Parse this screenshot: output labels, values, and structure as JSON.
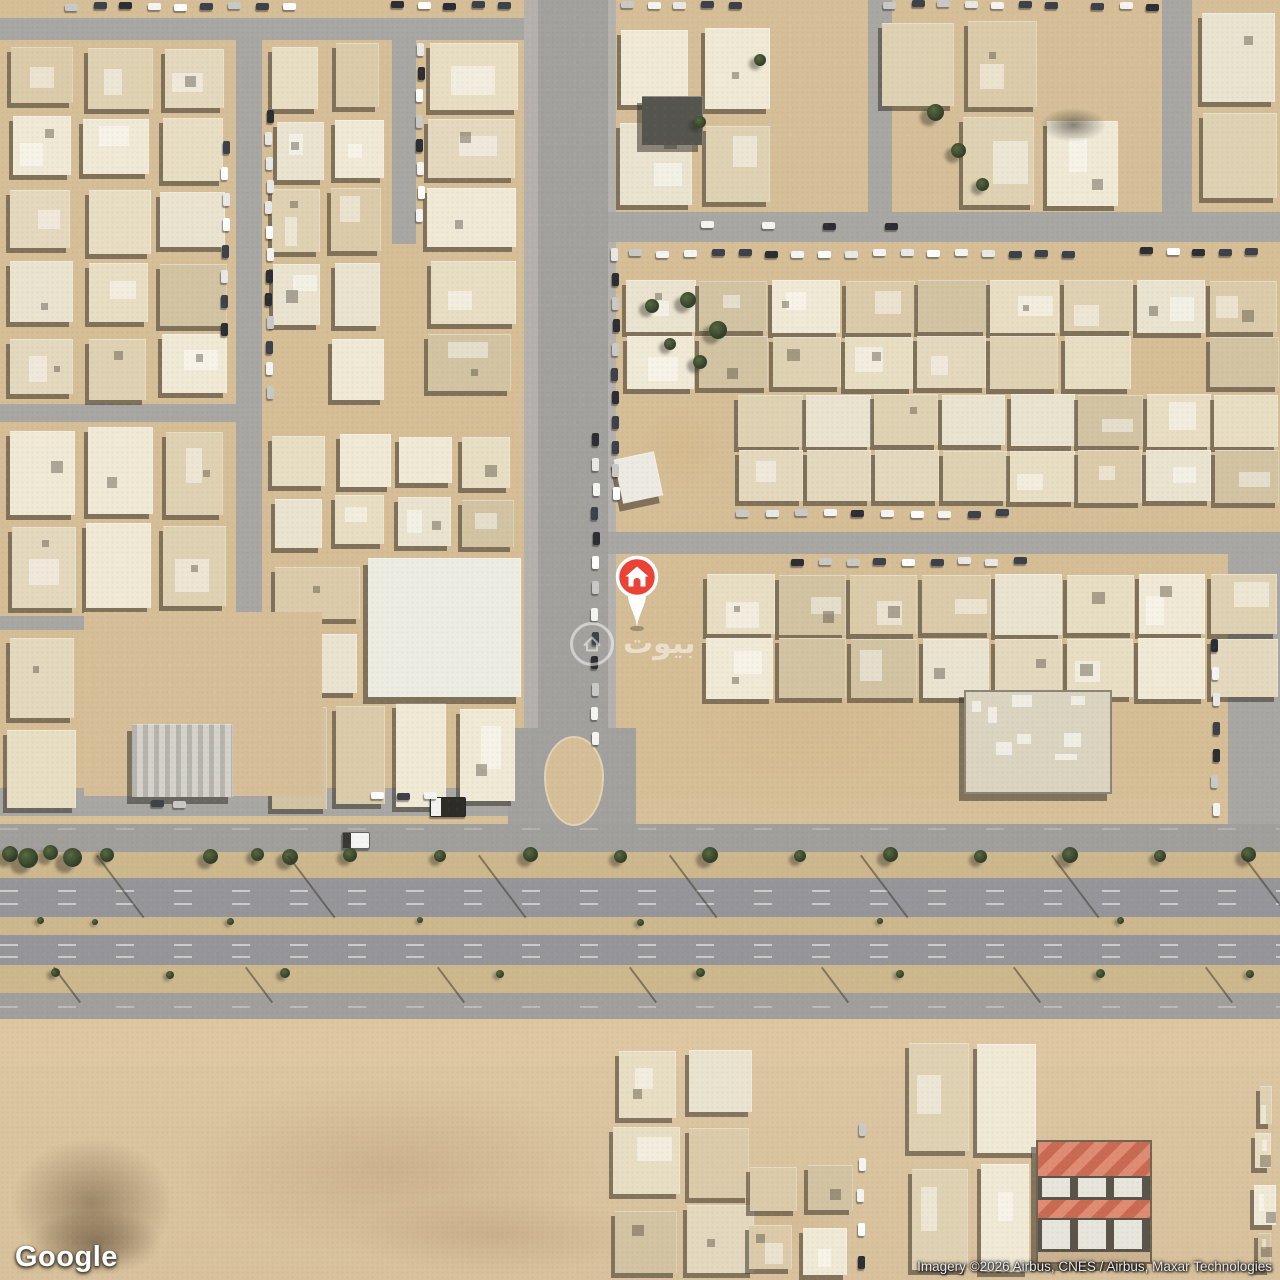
{
  "app": {
    "type": "satellite-map-embed"
  },
  "overlay": {
    "google_logo": "Google",
    "attribution": "Imagery ©2026 Airbus, CNES / Airbus, Maxar Technologies",
    "watermark": {
      "text": "بيوت",
      "icon": "house-outline-icon"
    },
    "marker": {
      "type": "property-pin",
      "icon": "house-icon",
      "x": 637,
      "y": 577,
      "color": "#EA4335"
    }
  },
  "palette": {
    "sand": "#d6bf98",
    "street": "#a9a7a3",
    "street_light": "#b5b2ae",
    "street_core": "#a3a19e",
    "highway": "#96969a",
    "service_road": "#a19f9c",
    "median": "#cdb88e",
    "building_shades": [
      "#e8dec4",
      "#dfd2b3",
      "#f0e9d6",
      "#dbcbaa",
      "#e4d8be",
      "#d2c3a3",
      "#eae3d0"
    ],
    "shadow": "rgba(43,38,30,0.5)",
    "tree_dark": "#33402a",
    "tree_light": "#57693f",
    "car_colors": [
      "#f4f4f2",
      "#ffffff",
      "#2c2e33",
      "#c9c9c7",
      "#3c414a",
      "#e8e8e6"
    ],
    "red_roof_a": "#e08b74",
    "red_roof_b": "#c96a52",
    "marker_red": "#EA4335"
  },
  "map": {
    "desert_blobs": [
      {
        "x": 0,
        "y": 1020,
        "w": 1280,
        "h": 46,
        "c": "rgba(224,199,162,0.5)",
        "r": 0
      },
      {
        "x": 150,
        "y": 1066,
        "w": 480,
        "h": 204,
        "c": "rgba(181,151,110,0.38)",
        "r": 40
      },
      {
        "x": 330,
        "y": 1190,
        "w": 330,
        "h": 90,
        "c": "rgba(172,142,102,0.32)",
        "r": 45
      },
      {
        "x": 0,
        "y": 1128,
        "w": 184,
        "h": 152,
        "c": "rgba(105,85,58,0.55)",
        "r": 40
      },
      {
        "x": 20,
        "y": 1205,
        "w": 150,
        "h": 75,
        "c": "rgba(86,68,46,0.5)",
        "r": 40
      },
      {
        "x": 612,
        "y": 600,
        "w": 390,
        "h": 230,
        "c": "rgba(213,182,138,0.45)",
        "r": 30
      },
      {
        "x": 660,
        "y": 1160,
        "w": 220,
        "h": 110,
        "c": "rgba(198,170,128,0.35)",
        "r": 40
      },
      {
        "x": 1150,
        "y": 420,
        "w": 130,
        "h": 400,
        "c": "rgba(216,190,150,0.4)",
        "r": 30
      },
      {
        "x": 620,
        "y": 390,
        "w": 120,
        "h": 115,
        "c": "rgba(214,180,134,0.5)",
        "r": 30
      }
    ],
    "streets": [
      {
        "x": 0,
        "y": 18,
        "w": 538,
        "h": 22,
        "k": "s"
      },
      {
        "x": 236,
        "y": 18,
        "w": 26,
        "h": 796,
        "k": "s"
      },
      {
        "x": 392,
        "y": 36,
        "w": 24,
        "h": 208,
        "k": "s"
      },
      {
        "x": 0,
        "y": 404,
        "w": 236,
        "h": 18,
        "k": "s"
      },
      {
        "x": 0,
        "y": 616,
        "w": 236,
        "h": 14,
        "k": "s"
      },
      {
        "x": 0,
        "y": 788,
        "w": 524,
        "h": 28,
        "k": "s"
      },
      {
        "x": 524,
        "y": 0,
        "w": 92,
        "h": 824,
        "k": "l"
      },
      {
        "x": 538,
        "y": 0,
        "w": 70,
        "h": 824,
        "k": "c"
      },
      {
        "x": 508,
        "y": 728,
        "w": 128,
        "h": 96,
        "k": "c"
      },
      {
        "x": 608,
        "y": 212,
        "w": 672,
        "h": 30,
        "k": "s"
      },
      {
        "x": 608,
        "y": 532,
        "w": 672,
        "h": 22,
        "k": "s"
      },
      {
        "x": 868,
        "y": 0,
        "w": 24,
        "h": 212,
        "k": "s"
      },
      {
        "x": 1162,
        "y": 0,
        "w": 30,
        "h": 212,
        "k": "s"
      },
      {
        "x": 1228,
        "y": 536,
        "w": 52,
        "h": 300,
        "k": "s"
      }
    ],
    "highway": {
      "bands": [
        {
          "y": 824,
          "h": 28,
          "k": "service"
        },
        {
          "y": 852,
          "h": 26,
          "k": "median"
        },
        {
          "y": 878,
          "h": 39,
          "k": "main"
        },
        {
          "y": 917,
          "h": 18,
          "k": "median"
        },
        {
          "y": 935,
          "h": 30,
          "k": "main"
        },
        {
          "y": 965,
          "h": 28,
          "k": "median"
        },
        {
          "y": 993,
          "h": 26,
          "k": "service"
        }
      ],
      "dashes": [
        {
          "y": 890,
          "a": 0.5
        },
        {
          "y": 903,
          "a": 0.5
        },
        {
          "y": 944,
          "a": 0.5
        },
        {
          "y": 956,
          "a": 0.5
        },
        {
          "y": 1006,
          "a": 0.3
        },
        {
          "y": 828,
          "a": 0.2
        }
      ],
      "island": {
        "x": 544,
        "y": 736,
        "w": 56,
        "h": 86
      }
    },
    "blocks": [
      {
        "x": 4,
        "y": 40,
        "w": 228,
        "h": 362,
        "cols": 3,
        "rows": 5,
        "seed": 11,
        "d": 0.93
      },
      {
        "x": 268,
        "y": 40,
        "w": 120,
        "h": 362,
        "cols": 2,
        "rows": 5,
        "seed": 12,
        "d": 0.92
      },
      {
        "x": 424,
        "y": 40,
        "w": 96,
        "h": 362,
        "cols": 1,
        "rows": 5,
        "seed": 13,
        "d": 0.92
      },
      {
        "x": 4,
        "y": 424,
        "w": 228,
        "h": 190,
        "cols": 3,
        "rows": 2,
        "seed": 14,
        "d": 0.9
      },
      {
        "x": 4,
        "y": 632,
        "w": 76,
        "h": 180,
        "cols": 1,
        "rows": 2,
        "seed": 15,
        "d": 0.9
      },
      {
        "x": 268,
        "y": 428,
        "w": 250,
        "h": 126,
        "cols": 4,
        "rows": 2,
        "seed": 16,
        "d": 0.88
      },
      {
        "x": 268,
        "y": 700,
        "w": 250,
        "h": 112,
        "cols": 4,
        "rows": 1,
        "seed": 17,
        "d": 0.8
      },
      {
        "x": 268,
        "y": 560,
        "w": 96,
        "h": 136,
        "cols": 1,
        "rows": 2,
        "seed": 18,
        "d": 0.85
      },
      {
        "x": 616,
        "y": 24,
        "w": 240,
        "h": 184,
        "cols": 3,
        "rows": 2,
        "seed": 19,
        "d": 0.75
      },
      {
        "x": 876,
        "y": 16,
        "w": 246,
        "h": 192,
        "cols": 3,
        "rows": 2,
        "seed": 20,
        "d": 0.8
      },
      {
        "x": 1196,
        "y": 8,
        "w": 84,
        "h": 200,
        "cols": 1,
        "rows": 2,
        "seed": 21,
        "d": 0.95
      },
      {
        "x": 624,
        "y": 278,
        "w": 656,
        "h": 112,
        "cols": 9,
        "rows": 2,
        "seed": 22,
        "d": 0.93,
        "t": 1
      },
      {
        "x": 736,
        "y": 392,
        "w": 544,
        "h": 112,
        "cols": 8,
        "rows": 2,
        "seed": 23,
        "d": 0.97,
        "t": 1
      },
      {
        "x": 704,
        "y": 572,
        "w": 576,
        "h": 128,
        "cols": 8,
        "rows": 2,
        "seed": 24,
        "d": 0.95,
        "t": 1
      },
      {
        "x": 610,
        "y": 1044,
        "w": 148,
        "h": 236,
        "cols": 2,
        "rows": 3,
        "seed": 25,
        "d": 0.92
      },
      {
        "x": 742,
        "y": 1160,
        "w": 114,
        "h": 120,
        "cols": 2,
        "rows": 2,
        "seed": 26,
        "d": 0.9
      },
      {
        "x": 906,
        "y": 1040,
        "w": 132,
        "h": 240,
        "cols": 2,
        "rows": 2,
        "seed": 27,
        "d": 0.92
      },
      {
        "x": 1252,
        "y": 1078,
        "w": 28,
        "h": 100,
        "cols": 1,
        "rows": 2,
        "seed": 28,
        "d": 1
      },
      {
        "x": 1250,
        "y": 1180,
        "w": 30,
        "h": 100,
        "cols": 1,
        "rows": 2,
        "seed": 29,
        "d": 1
      }
    ],
    "specials": [
      {
        "t": "sand",
        "x": 84,
        "y": 612,
        "w": 238,
        "h": 184
      },
      {
        "t": "plain",
        "x": 368,
        "y": 558,
        "w": 152,
        "h": 138,
        "c": "#edece3"
      },
      {
        "t": "warehouse",
        "x": 132,
        "y": 724,
        "w": 100,
        "h": 72,
        "c": "#d5d2cb"
      },
      {
        "t": "plain",
        "x": 642,
        "y": 96,
        "w": 60,
        "h": 48,
        "c": "#55554f"
      },
      {
        "t": "shade",
        "x": 1036,
        "y": 106,
        "w": 74,
        "h": 38,
        "c": "rgba(30,28,24,0.5)"
      },
      {
        "t": "plain",
        "x": 618,
        "y": 455,
        "w": 40,
        "h": 44,
        "c": "#eceae2",
        "rot": -12
      },
      {
        "t": "debris",
        "x": 964,
        "y": 690,
        "w": 144,
        "h": 100,
        "c": "#dbd4c1"
      },
      {
        "t": "redcompound",
        "x": 1036,
        "y": 1140,
        "w": 112,
        "h": 120
      },
      {
        "t": "truck",
        "x": 342,
        "y": 832,
        "w": 26,
        "h": 15,
        "c": "#f5f5f3"
      },
      {
        "t": "truck",
        "x": 430,
        "y": 797,
        "w": 34,
        "h": 18,
        "c": "#2e2c29"
      }
    ],
    "trees": [
      {
        "x": 10,
        "y": 854,
        "s": 16
      },
      {
        "x": 28,
        "y": 858,
        "s": 20
      },
      {
        "x": 50,
        "y": 852,
        "s": 15
      },
      {
        "x": 72,
        "y": 857,
        "s": 19
      },
      {
        "x": 107,
        "y": 855,
        "s": 14
      },
      {
        "x": 210,
        "y": 856,
        "s": 15
      },
      {
        "x": 257,
        "y": 854,
        "s": 13
      },
      {
        "x": 290,
        "y": 857,
        "s": 16
      },
      {
        "x": 350,
        "y": 855,
        "s": 14
      },
      {
        "x": 440,
        "y": 856,
        "s": 12
      },
      {
        "x": 530,
        "y": 854,
        "s": 15
      },
      {
        "x": 620,
        "y": 856,
        "s": 13
      },
      {
        "x": 710,
        "y": 855,
        "s": 16
      },
      {
        "x": 800,
        "y": 856,
        "s": 12
      },
      {
        "x": 890,
        "y": 854,
        "s": 15
      },
      {
        "x": 980,
        "y": 856,
        "s": 13
      },
      {
        "x": 1070,
        "y": 855,
        "s": 16
      },
      {
        "x": 1160,
        "y": 856,
        "s": 12
      },
      {
        "x": 1248,
        "y": 854,
        "s": 15
      },
      {
        "x": 40,
        "y": 920,
        "s": 7
      },
      {
        "x": 95,
        "y": 922,
        "s": 6
      },
      {
        "x": 230,
        "y": 921,
        "s": 7
      },
      {
        "x": 420,
        "y": 920,
        "s": 6
      },
      {
        "x": 640,
        "y": 922,
        "s": 7
      },
      {
        "x": 880,
        "y": 921,
        "s": 6
      },
      {
        "x": 1120,
        "y": 920,
        "s": 7
      },
      {
        "x": 55,
        "y": 972,
        "s": 9
      },
      {
        "x": 170,
        "y": 975,
        "s": 8
      },
      {
        "x": 285,
        "y": 973,
        "s": 10
      },
      {
        "x": 500,
        "y": 974,
        "s": 8
      },
      {
        "x": 700,
        "y": 972,
        "s": 9
      },
      {
        "x": 900,
        "y": 974,
        "s": 8
      },
      {
        "x": 1100,
        "y": 973,
        "s": 9
      },
      {
        "x": 1250,
        "y": 974,
        "s": 8
      },
      {
        "x": 935,
        "y": 112,
        "s": 17
      },
      {
        "x": 958,
        "y": 150,
        "s": 15
      },
      {
        "x": 982,
        "y": 184,
        "s": 13
      },
      {
        "x": 700,
        "y": 122,
        "s": 12
      },
      {
        "x": 652,
        "y": 306,
        "s": 14
      },
      {
        "x": 670,
        "y": 344,
        "s": 12
      },
      {
        "x": 688,
        "y": 300,
        "s": 16
      },
      {
        "x": 718,
        "y": 330,
        "s": 18
      },
      {
        "x": 700,
        "y": 362,
        "s": 14
      },
      {
        "x": 760,
        "y": 60,
        "s": 12
      }
    ],
    "poles": [
      {
        "x": 96,
        "y": 856,
        "len": 78
      },
      {
        "x": 287,
        "y": 856,
        "len": 78
      },
      {
        "x": 478,
        "y": 856,
        "len": 78
      },
      {
        "x": 669,
        "y": 856,
        "len": 78
      },
      {
        "x": 860,
        "y": 856,
        "len": 78
      },
      {
        "x": 1051,
        "y": 856,
        "len": 78
      },
      {
        "x": 1242,
        "y": 856,
        "len": 78
      },
      {
        "x": 53,
        "y": 968,
        "len": 44
      },
      {
        "x": 245,
        "y": 968,
        "len": 44
      },
      {
        "x": 437,
        "y": 968,
        "len": 44
      },
      {
        "x": 629,
        "y": 968,
        "len": 44
      },
      {
        "x": 821,
        "y": 968,
        "len": 44
      },
      {
        "x": 1013,
        "y": 968,
        "len": 44
      },
      {
        "x": 1205,
        "y": 968,
        "len": 44
      }
    ],
    "car_rows": [
      {
        "x": 66,
        "y": 3,
        "dx": 27,
        "n": 9,
        "o": "h"
      },
      {
        "x": 390,
        "y": 2,
        "dx": 27,
        "n": 5,
        "o": "h"
      },
      {
        "x": 620,
        "y": 2,
        "dx": 27,
        "n": 5,
        "o": "h"
      },
      {
        "x": 884,
        "y": 1,
        "dx": 27,
        "n": 7,
        "o": "h"
      },
      {
        "x": 1092,
        "y": 3,
        "dx": 27,
        "n": 3,
        "o": "h"
      },
      {
        "x": 266,
        "y": 110,
        "dy": 23,
        "n": 13,
        "o": "v"
      },
      {
        "x": 222,
        "y": 140,
        "dy": 26,
        "n": 8,
        "o": "v"
      },
      {
        "x": 417,
        "y": 42,
        "dy": 24,
        "n": 8,
        "o": "v"
      },
      {
        "x": 612,
        "y": 248,
        "dy": 24,
        "n": 11,
        "o": "v"
      },
      {
        "x": 592,
        "y": 432,
        "dy": 25,
        "n": 13,
        "o": "v"
      },
      {
        "x": 630,
        "y": 250,
        "dx": 27,
        "n": 17,
        "o": "h"
      },
      {
        "x": 700,
        "y": 222,
        "dx": 62,
        "n": 4,
        "o": "h"
      },
      {
        "x": 1140,
        "y": 248,
        "dx": 26,
        "n": 5,
        "o": "h"
      },
      {
        "x": 736,
        "y": 510,
        "dx": 29,
        "n": 10,
        "o": "h"
      },
      {
        "x": 790,
        "y": 558,
        "dx": 28,
        "n": 9,
        "o": "h"
      },
      {
        "x": 1212,
        "y": 640,
        "dy": 27,
        "n": 7,
        "o": "v"
      },
      {
        "x": 858,
        "y": 1124,
        "dy": 33,
        "n": 5,
        "o": "v"
      },
      {
        "x": 372,
        "y": 792,
        "dx": 26,
        "n": 3,
        "o": "h"
      },
      {
        "x": 150,
        "y": 800,
        "dx": 24,
        "n": 2,
        "o": "h"
      }
    ]
  }
}
